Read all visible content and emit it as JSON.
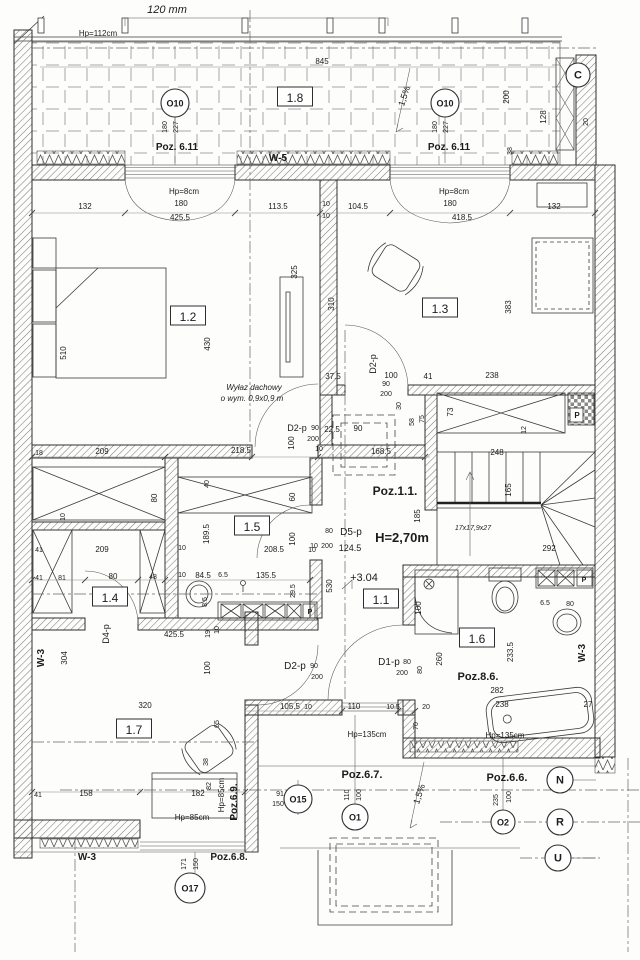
{
  "drawing": {
    "scale_note": "120 mm",
    "height_note": "H=2,70m",
    "level_note": "+3.04",
    "stair_note": "17x17,9x27",
    "roof_hatch_note": [
      "Wyłaz dachowy",
      "o wym. 0,9x0,9 m"
    ]
  },
  "rooms": [
    {
      "t": "1.8",
      "x": 295,
      "y": 99
    },
    {
      "t": "1.2",
      "x": 188,
      "y": 318
    },
    {
      "t": "1.3",
      "x": 440,
      "y": 310
    },
    {
      "t": "1.5",
      "x": 252,
      "y": 528
    },
    {
      "t": "1.4",
      "x": 110,
      "y": 599
    },
    {
      "t": "1.1",
      "x": 381,
      "y": 601
    },
    {
      "t": "1.6",
      "x": 477,
      "y": 640
    },
    {
      "t": "1.7",
      "x": 134,
      "y": 731
    }
  ],
  "marks": [
    {
      "t": "O10",
      "x": 175,
      "y": 103,
      "rad": 14,
      "n": "window-mark-o10-left"
    },
    {
      "t": "O10",
      "x": 445,
      "y": 103,
      "rad": 14,
      "n": "window-mark-o10-right"
    },
    {
      "t": "C",
      "x": 578,
      "y": 75,
      "rad": 12,
      "n": "axis-mark-c"
    },
    {
      "t": "O15",
      "x": 298,
      "y": 799,
      "rad": 14,
      "n": "window-mark-o15"
    },
    {
      "t": "O1",
      "x": 355,
      "y": 817,
      "rad": 13,
      "n": "window-mark-o1"
    },
    {
      "t": "O2",
      "x": 503,
      "y": 822,
      "rad": 12,
      "n": "window-mark-o2"
    },
    {
      "t": "N",
      "x": 560,
      "y": 780,
      "rad": 13,
      "n": "axis-mark-n"
    },
    {
      "t": "R",
      "x": 560,
      "y": 822,
      "rad": 13,
      "n": "axis-mark-r"
    },
    {
      "t": "U",
      "x": 558,
      "y": 858,
      "rad": 13,
      "n": "axis-mark-u"
    },
    {
      "t": "O17",
      "x": 190,
      "y": 888,
      "rad": 15,
      "n": "window-mark-o17"
    }
  ],
  "texts": [
    {
      "t": "120 mm",
      "x": 167,
      "y": 13,
      "s": 11,
      "i": 1
    },
    {
      "t": "Hp=112cm",
      "x": 98,
      "y": 36,
      "s": 8
    },
    {
      "t": "845",
      "x": 322,
      "y": 64,
      "s": 8
    },
    {
      "t": "1,5%",
      "x": 407,
      "y": 97,
      "r": -72,
      "s": 9
    },
    {
      "t": "180",
      "x": 167,
      "y": 127,
      "r": -90,
      "s": 7
    },
    {
      "t": "227",
      "x": 178,
      "y": 127,
      "r": -90,
      "s": 7
    },
    {
      "t": "180",
      "x": 437,
      "y": 127,
      "r": -90,
      "s": 7
    },
    {
      "t": "227",
      "x": 448,
      "y": 127,
      "r": -90,
      "s": 7
    },
    {
      "t": "200",
      "x": 509,
      "y": 97,
      "r": -90,
      "s": 8
    },
    {
      "t": "128",
      "x": 546,
      "y": 117,
      "r": -90,
      "s": 8
    },
    {
      "t": "20",
      "x": 588,
      "y": 122,
      "r": -90,
      "s": 7
    },
    {
      "t": "38",
      "x": 512,
      "y": 151,
      "r": -90,
      "s": 7
    },
    {
      "t": "Poz. 6.11",
      "x": 177,
      "y": 150,
      "s": 10,
      "b": 1
    },
    {
      "t": "Poz. 6.11",
      "x": 449,
      "y": 150,
      "s": 10,
      "b": 1
    },
    {
      "t": "W-5",
      "x": 278,
      "y": 161,
      "s": 10,
      "b": 1
    },
    {
      "t": "132",
      "x": 85,
      "y": 209,
      "s": 8
    },
    {
      "t": "Hp=8cm",
      "x": 184,
      "y": 194,
      "s": 8
    },
    {
      "t": "180",
      "x": 181,
      "y": 206,
      "s": 8
    },
    {
      "t": "425.5",
      "x": 180,
      "y": 220,
      "s": 8
    },
    {
      "t": "113.5",
      "x": 278,
      "y": 209,
      "s": 8
    },
    {
      "t": "10",
      "x": 326,
      "y": 206,
      "s": 7
    },
    {
      "t": "10",
      "x": 326,
      "y": 218,
      "s": 7
    },
    {
      "t": "104.5",
      "x": 358,
      "y": 209,
      "s": 8
    },
    {
      "t": "Hp=8cm",
      "x": 454,
      "y": 194,
      "s": 8
    },
    {
      "t": "180",
      "x": 450,
      "y": 206,
      "s": 8
    },
    {
      "t": "418.5",
      "x": 462,
      "y": 220,
      "s": 8
    },
    {
      "t": "132",
      "x": 554,
      "y": 209,
      "s": 8
    },
    {
      "t": "510",
      "x": 66,
      "y": 353,
      "r": -90,
      "s": 8
    },
    {
      "t": "430",
      "x": 210,
      "y": 344,
      "r": -90,
      "s": 8
    },
    {
      "t": "325",
      "x": 297,
      "y": 272,
      "r": -90,
      "s": 8
    },
    {
      "t": "310",
      "x": 334,
      "y": 304,
      "r": -90,
      "s": 8
    },
    {
      "t": "383",
      "x": 511,
      "y": 307,
      "r": -90,
      "s": 8
    },
    {
      "t": "37.5",
      "x": 333,
      "y": 379,
      "s": 8
    },
    {
      "t": "100",
      "x": 391,
      "y": 378,
      "s": 8
    },
    {
      "t": "41",
      "x": 428,
      "y": 379,
      "s": 8
    },
    {
      "t": "238",
      "x": 492,
      "y": 378,
      "s": 8
    },
    {
      "t": "73",
      "x": 453,
      "y": 412,
      "r": -90,
      "s": 8
    },
    {
      "t": "12",
      "x": 526,
      "y": 430,
      "r": -90,
      "s": 7
    },
    {
      "t": "D2-p",
      "x": 376,
      "y": 364,
      "r": -90,
      "s": 9
    },
    {
      "t": "90",
      "x": 386,
      "y": 386,
      "s": 7
    },
    {
      "t": "200",
      "x": 386,
      "y": 396,
      "s": 7
    },
    {
      "t": "30",
      "x": 401,
      "y": 406,
      "r": -90,
      "s": 7
    },
    {
      "t": "58",
      "x": 414,
      "y": 422,
      "r": -90,
      "s": 7
    },
    {
      "t": "75",
      "x": 424,
      "y": 419,
      "r": -90,
      "s": 7
    },
    {
      "t": "Wyłaz dachowy",
      "x": 254,
      "y": 390,
      "s": 8,
      "i": 1
    },
    {
      "t": "o wym. 0,9x0,9 m",
      "x": 252,
      "y": 401,
      "s": 8,
      "i": 1
    },
    {
      "t": "D2-p",
      "x": 297,
      "y": 431,
      "s": 9
    },
    {
      "t": "90",
      "x": 315,
      "y": 430,
      "s": 7
    },
    {
      "t": "200",
      "x": 313,
      "y": 441,
      "s": 7
    },
    {
      "t": "22.5",
      "x": 332,
      "y": 432,
      "s": 8
    },
    {
      "t": "90",
      "x": 358,
      "y": 431,
      "s": 8
    },
    {
      "t": "10",
      "x": 319,
      "y": 451,
      "s": 7
    },
    {
      "t": "100",
      "x": 294,
      "y": 443,
      "r": -90,
      "s": 8
    },
    {
      "t": "168.5",
      "x": 381,
      "y": 454,
      "s": 8
    },
    {
      "t": "218.5",
      "x": 241,
      "y": 453,
      "s": 8
    },
    {
      "t": "18",
      "x": 39,
      "y": 455,
      "s": 7
    },
    {
      "t": "209",
      "x": 102,
      "y": 454,
      "s": 8
    },
    {
      "t": "Poz.1.1.",
      "x": 395,
      "y": 495,
      "s": 12,
      "b": 1
    },
    {
      "t": "H=2,70m",
      "x": 402,
      "y": 542,
      "s": 13,
      "b": 1
    },
    {
      "t": "+3.04",
      "x": 364,
      "y": 581,
      "s": 11
    },
    {
      "t": "248",
      "x": 497,
      "y": 455,
      "s": 8
    },
    {
      "t": "165",
      "x": 511,
      "y": 490,
      "r": -90,
      "s": 8
    },
    {
      "t": "185",
      "x": 420,
      "y": 516,
      "r": -90,
      "s": 8
    },
    {
      "t": "292",
      "x": 549,
      "y": 551,
      "s": 8
    },
    {
      "t": "17x17,9x27",
      "x": 473,
      "y": 530,
      "s": 7,
      "i": 1
    },
    {
      "t": "80",
      "x": 157,
      "y": 498,
      "r": -90,
      "s": 8
    },
    {
      "t": "10",
      "x": 65,
      "y": 517,
      "r": -90,
      "s": 7
    },
    {
      "t": "40",
      "x": 209,
      "y": 484,
      "r": -90,
      "s": 7
    },
    {
      "t": "60",
      "x": 295,
      "y": 497,
      "r": -90,
      "s": 8
    },
    {
      "t": "41",
      "x": 39,
      "y": 552,
      "s": 7
    },
    {
      "t": "209",
      "x": 102,
      "y": 552,
      "s": 8
    },
    {
      "t": "10",
      "x": 182,
      "y": 550,
      "s": 7
    },
    {
      "t": "189.5",
      "x": 209,
      "y": 534,
      "r": -90,
      "s": 8
    },
    {
      "t": "208.5",
      "x": 274,
      "y": 552,
      "s": 8
    },
    {
      "t": "100",
      "x": 295,
      "y": 539,
      "r": -90,
      "s": 8
    },
    {
      "t": "10",
      "x": 312,
      "y": 552,
      "s": 7
    },
    {
      "t": "41",
      "x": 39,
      "y": 580,
      "s": 7
    },
    {
      "t": "81",
      "x": 62,
      "y": 580,
      "s": 7
    },
    {
      "t": "80",
      "x": 113,
      "y": 579,
      "s": 8
    },
    {
      "t": "48",
      "x": 153,
      "y": 579,
      "s": 7
    },
    {
      "t": "10",
      "x": 182,
      "y": 577,
      "s": 7
    },
    {
      "t": "84.5",
      "x": 203,
      "y": 578,
      "s": 8
    },
    {
      "t": "6.5",
      "x": 223,
      "y": 577,
      "s": 7
    },
    {
      "t": "135.5",
      "x": 266,
      "y": 578,
      "s": 8
    },
    {
      "t": "29.5",
      "x": 295,
      "y": 591,
      "r": -90,
      "s": 7
    },
    {
      "t": "8.5",
      "x": 207,
      "y": 602,
      "r": -90,
      "s": 7
    },
    {
      "t": "19",
      "x": 210,
      "y": 634,
      "r": -90,
      "s": 7
    },
    {
      "t": "10",
      "x": 219,
      "y": 630,
      "r": -90,
      "s": 7
    },
    {
      "t": "425.5",
      "x": 174,
      "y": 637,
      "s": 8
    },
    {
      "t": "D4-p",
      "x": 109,
      "y": 634,
      "r": -90,
      "s": 9
    },
    {
      "t": "80",
      "x": 329,
      "y": 533,
      "s": 7
    },
    {
      "t": "D5-p",
      "x": 351,
      "y": 535,
      "s": 10
    },
    {
      "t": "10",
      "x": 314,
      "y": 548,
      "s": 7
    },
    {
      "t": "200",
      "x": 327,
      "y": 548,
      "s": 7
    },
    {
      "t": "124.5",
      "x": 350,
      "y": 551,
      "s": 9
    },
    {
      "t": "530",
      "x": 332,
      "y": 586,
      "r": -90,
      "s": 8
    },
    {
      "t": "100",
      "x": 421,
      "y": 608,
      "r": -90,
      "s": 8
    },
    {
      "t": "D1-p",
      "x": 389,
      "y": 665,
      "s": 10
    },
    {
      "t": "80",
      "x": 407,
      "y": 664,
      "s": 7
    },
    {
      "t": "200",
      "x": 402,
      "y": 675,
      "s": 7
    },
    {
      "t": "80",
      "x": 422,
      "y": 670,
      "r": -90,
      "s": 7
    },
    {
      "t": "260",
      "x": 442,
      "y": 659,
      "r": -90,
      "s": 8
    },
    {
      "t": "W-3",
      "x": 44,
      "y": 658,
      "r": -90,
      "s": 10,
      "b": 1
    },
    {
      "t": "304",
      "x": 67,
      "y": 658,
      "r": -90,
      "s": 8
    },
    {
      "t": "100",
      "x": 210,
      "y": 668,
      "r": -90,
      "s": 8
    },
    {
      "t": "D2-p",
      "x": 295,
      "y": 669,
      "s": 10
    },
    {
      "t": "90",
      "x": 314,
      "y": 668,
      "s": 7
    },
    {
      "t": "200",
      "x": 317,
      "y": 679,
      "s": 7
    },
    {
      "t": "320",
      "x": 145,
      "y": 708,
      "s": 8
    },
    {
      "t": "105.5",
      "x": 290,
      "y": 709,
      "s": 8
    },
    {
      "t": "10",
      "x": 308,
      "y": 709,
      "s": 7
    },
    {
      "t": "110",
      "x": 354,
      "y": 709,
      "s": 8
    },
    {
      "t": "10.5",
      "x": 393,
      "y": 709,
      "s": 7
    },
    {
      "t": "20",
      "x": 426,
      "y": 709,
      "s": 7
    },
    {
      "t": "70",
      "x": 418,
      "y": 726,
      "r": -90,
      "s": 7
    },
    {
      "t": "Hp=135cm",
      "x": 367,
      "y": 737,
      "s": 8
    },
    {
      "t": "65",
      "x": 219,
      "y": 724,
      "r": -90,
      "s": 7
    },
    {
      "t": "38",
      "x": 208,
      "y": 762,
      "r": -90,
      "s": 7
    },
    {
      "t": "41",
      "x": 38,
      "y": 797,
      "s": 7
    },
    {
      "t": "158",
      "x": 86,
      "y": 796,
      "s": 8
    },
    {
      "t": "182",
      "x": 198,
      "y": 796,
      "s": 8
    },
    {
      "t": "82",
      "x": 211,
      "y": 786,
      "r": -90,
      "s": 7
    },
    {
      "t": "Hp=85cm",
      "x": 192,
      "y": 820,
      "s": 8
    },
    {
      "t": "Hp=85cm",
      "x": 224,
      "y": 795,
      "r": -90,
      "s": 8
    },
    {
      "t": "Poz.6.9.",
      "x": 237,
      "y": 802,
      "r": -90,
      "s": 10,
      "b": 1
    },
    {
      "t": "Poz.6.7.",
      "x": 362,
      "y": 778,
      "s": 11,
      "b": 1
    },
    {
      "t": "91",
      "x": 280,
      "y": 796,
      "s": 7
    },
    {
      "t": "150",
      "x": 278,
      "y": 806,
      "s": 7
    },
    {
      "t": "110",
      "x": 349,
      "y": 795,
      "r": -90,
      "s": 7
    },
    {
      "t": "100",
      "x": 361,
      "y": 795,
      "r": -90,
      "s": 7
    },
    {
      "t": "1,5%",
      "x": 422,
      "y": 795,
      "r": -72,
      "s": 9
    },
    {
      "t": "W-3",
      "x": 87,
      "y": 860,
      "s": 10,
      "b": 1
    },
    {
      "t": "Poz.6.8.",
      "x": 229,
      "y": 860,
      "s": 10,
      "b": 1
    },
    {
      "t": "171",
      "x": 186,
      "y": 864,
      "r": -90,
      "s": 7
    },
    {
      "t": "150",
      "x": 198,
      "y": 864,
      "r": -90,
      "s": 7
    },
    {
      "t": "233.5",
      "x": 513,
      "y": 652,
      "r": -90,
      "s": 8
    },
    {
      "t": "Poz.8.6.",
      "x": 478,
      "y": 680,
      "s": 11,
      "b": 1
    },
    {
      "t": "282",
      "x": 497,
      "y": 693,
      "s": 8
    },
    {
      "t": "238",
      "x": 502,
      "y": 707,
      "s": 8
    },
    {
      "t": "27",
      "x": 588,
      "y": 707,
      "s": 8
    },
    {
      "t": "6.5",
      "x": 545,
      "y": 605,
      "s": 7
    },
    {
      "t": "80",
      "x": 570,
      "y": 606,
      "s": 7
    },
    {
      "t": "Hp=135cm",
      "x": 505,
      "y": 738,
      "s": 8
    },
    {
      "t": "W-3",
      "x": 585,
      "y": 653,
      "r": -90,
      "s": 10,
      "b": 1
    },
    {
      "t": "Poz.6.6.",
      "x": 507,
      "y": 781,
      "s": 11,
      "b": 1
    },
    {
      "t": "235",
      "x": 498,
      "y": 800,
      "r": -90,
      "s": 7
    },
    {
      "t": "100",
      "x": 511,
      "y": 797,
      "r": -90,
      "s": 7
    },
    {
      "t": "P",
      "x": 310,
      "y": 614,
      "s": 7,
      "b": 1
    },
    {
      "t": "P",
      "x": 584,
      "y": 582,
      "s": 7,
      "b": 1
    },
    {
      "t": "P",
      "x": 577,
      "y": 418,
      "s": 8,
      "b": 1
    }
  ]
}
